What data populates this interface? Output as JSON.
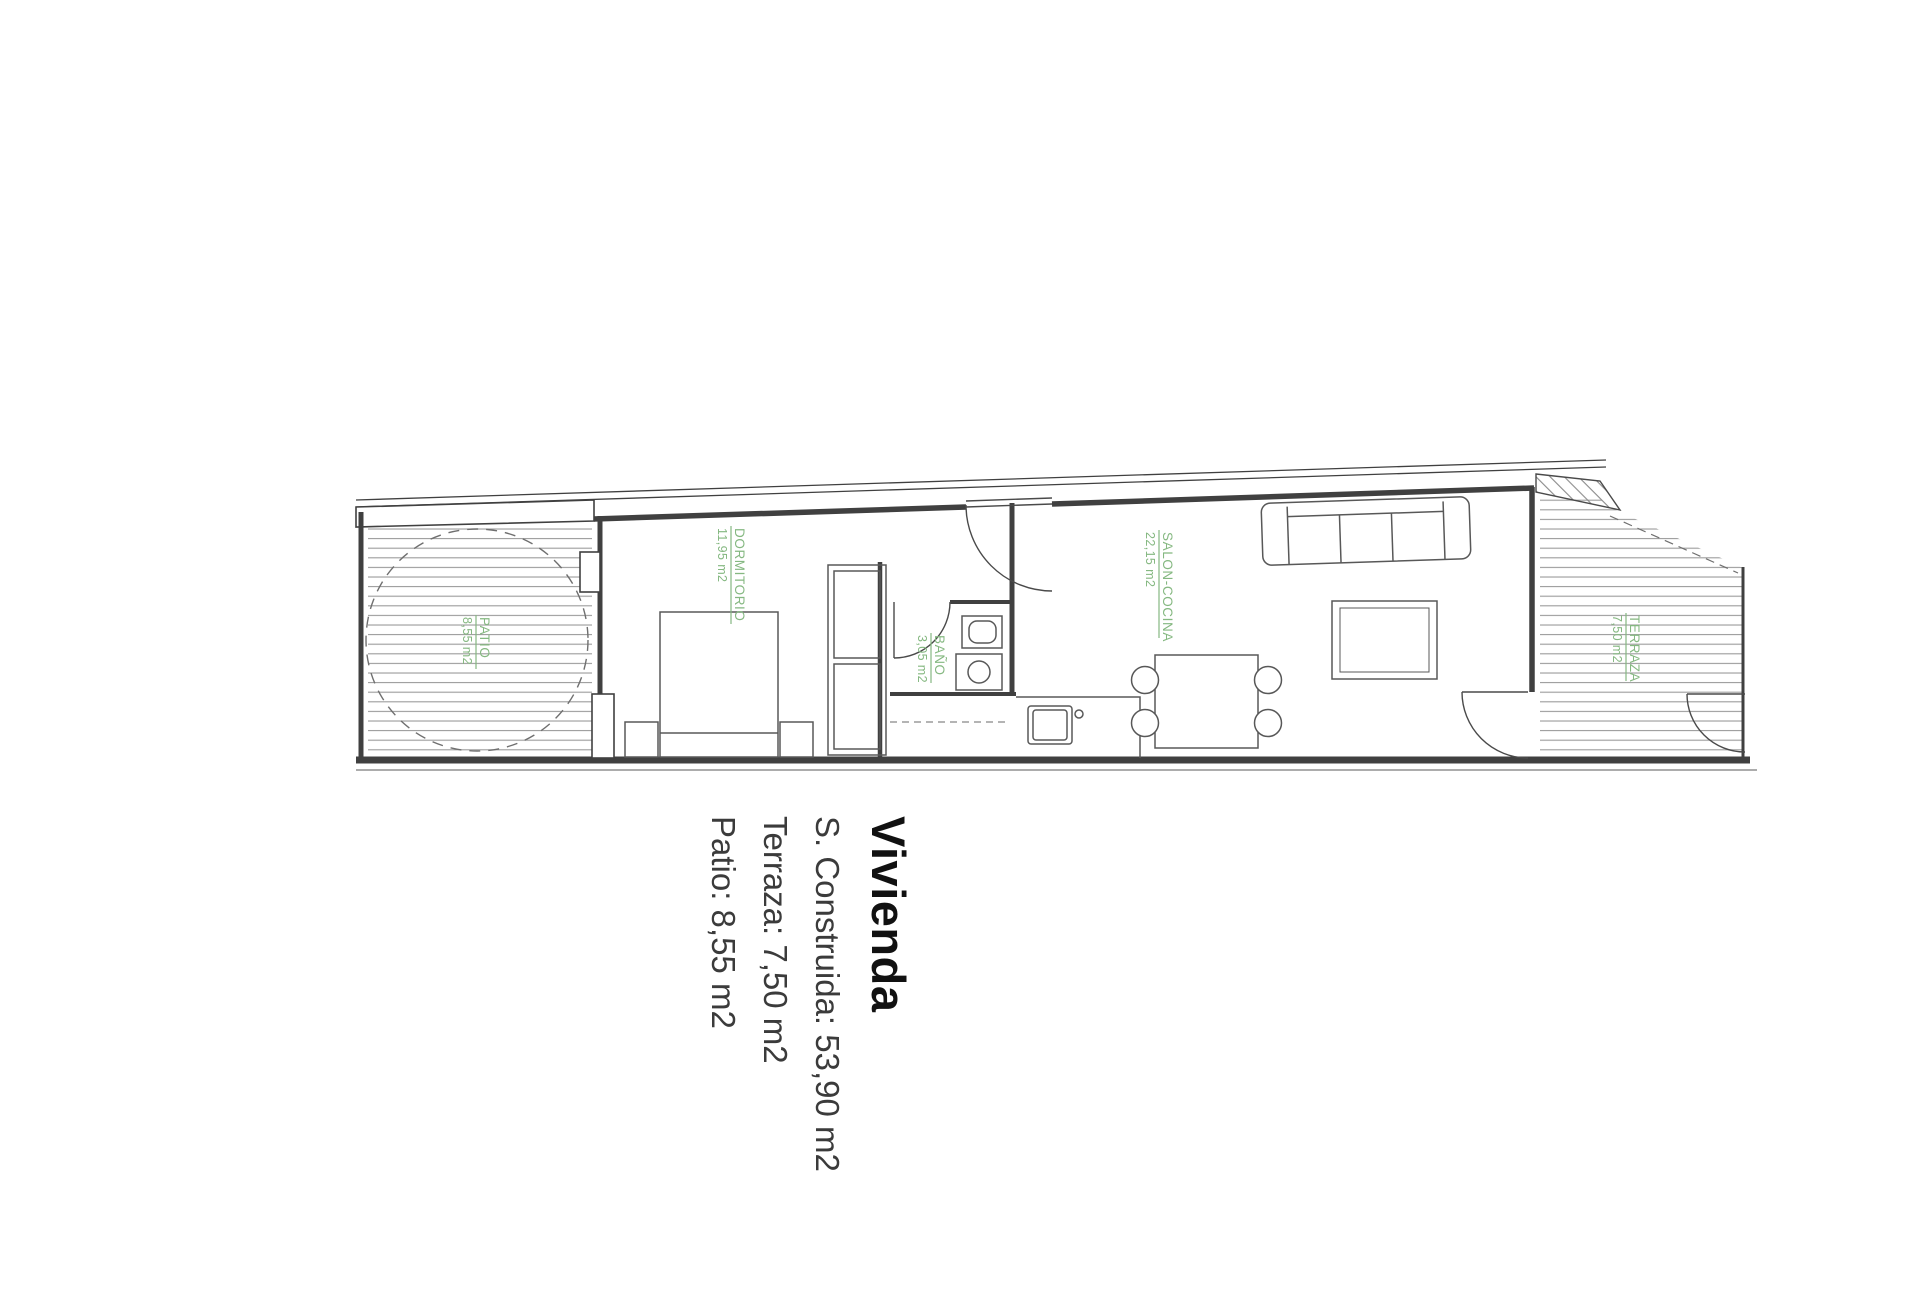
{
  "title": "Vivienda",
  "summary": [
    "S. Construida: 53,90 m2",
    "Terraza: 7,50 m2",
    "Patio: 8,55 m2"
  ],
  "rooms": [
    {
      "name": "PATIO",
      "area": "8,55 m2"
    },
    {
      "name": "DORMITORIO",
      "area": "11,95 m2"
    },
    {
      "name": "BAÑO",
      "area": "3,05 m2"
    },
    {
      "name": "SALON-COCINA",
      "area": "22,15 m2"
    },
    {
      "name": "TERRAZA",
      "area": "7,50 m2"
    }
  ],
  "colors": {
    "label_green": "#85b881",
    "wall_dark": "#404040",
    "hatch_gray": "#9a9a9a"
  }
}
